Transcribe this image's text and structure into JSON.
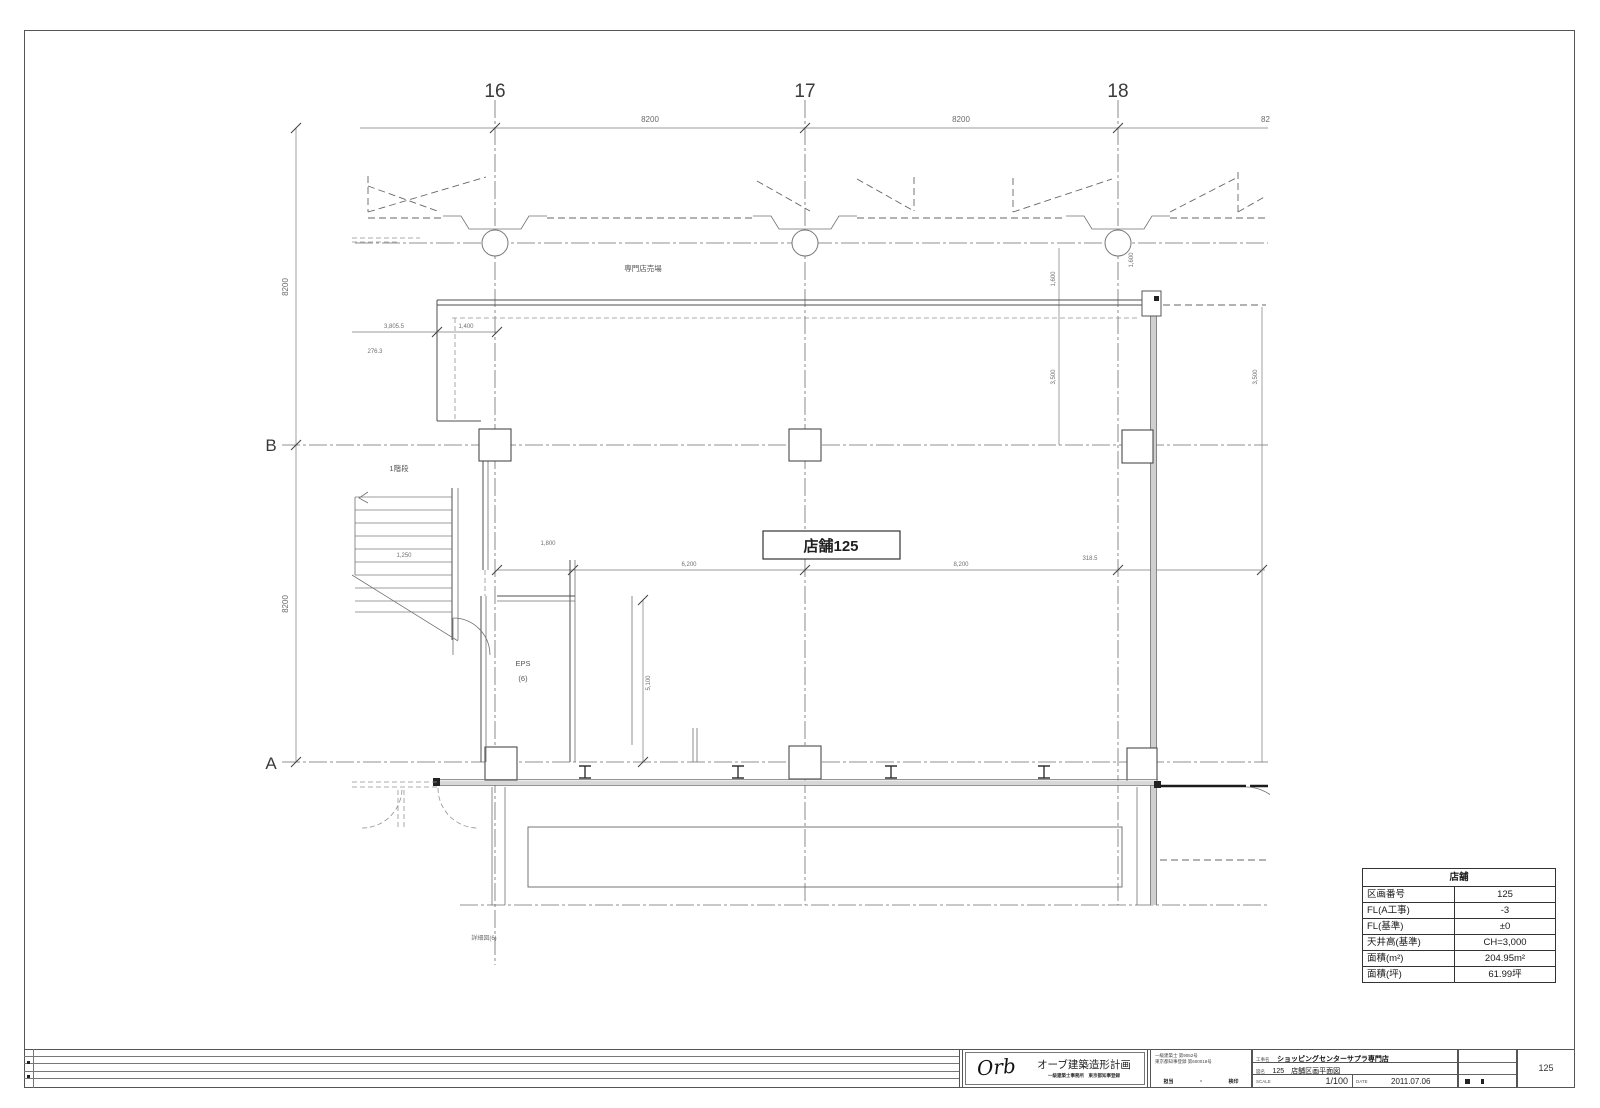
{
  "grid": {
    "c1": "16",
    "c2": "17",
    "c3": "18",
    "rB": "B",
    "rA": "A"
  },
  "dims": {
    "top1": "8200",
    "top2": "8200",
    "top3": "8200",
    "left1": "8200",
    "left2": "8200",
    "a1": "3,805.5",
    "a2": "1,400",
    "a3": "276.3",
    "b1": "1,800",
    "b2": "6,200",
    "b3": "8,200",
    "b4": "318.5",
    "c1": "5,100",
    "c2": "1,250",
    "v1": "1,600",
    "v2": "1,600",
    "v3": "3,500",
    "v4": "3,500"
  },
  "texts": {
    "floor_area": "専門店売場",
    "store": "店舗125",
    "eps1": "EPS",
    "eps2": "(6)",
    "stair": "1階段",
    "detail": "詳細図(6)"
  },
  "info_table": {
    "title": "店舗",
    "rows": [
      {
        "label": "区画番号",
        "value": "125"
      },
      {
        "label": "FL(A工事)",
        "value": "-3"
      },
      {
        "label": "FL(基準)",
        "value": "±0"
      },
      {
        "label": "天井高(基準)",
        "value": "CH=3,000"
      },
      {
        "label": "面積(m²)",
        "value": "204.95m²"
      },
      {
        "label": "面積(坪)",
        "value": "61.99坪"
      }
    ]
  },
  "title_block": {
    "firm_logo": "Orb",
    "firm_name": "オーブ建築造形計画",
    "firm_sub": "一級建築士事務所　東京都知事登録",
    "reg_line1": "一級建築士 第9052号",
    "reg_line2": "東京都知事登録 第600018号",
    "stamp_left": "担当",
    "stamp_mid": "・",
    "stamp_right": "検印",
    "project_label": "工事名",
    "project_name": "ショッピングセンターサプラ専門店",
    "sheet_label": "図名",
    "sheet_name": "125　店舗区画平面図",
    "scale_label": "SCALE",
    "scale_value": "1/100",
    "date_label": "DATE",
    "date_value": "2011.07.06",
    "sheet_no": "125"
  }
}
